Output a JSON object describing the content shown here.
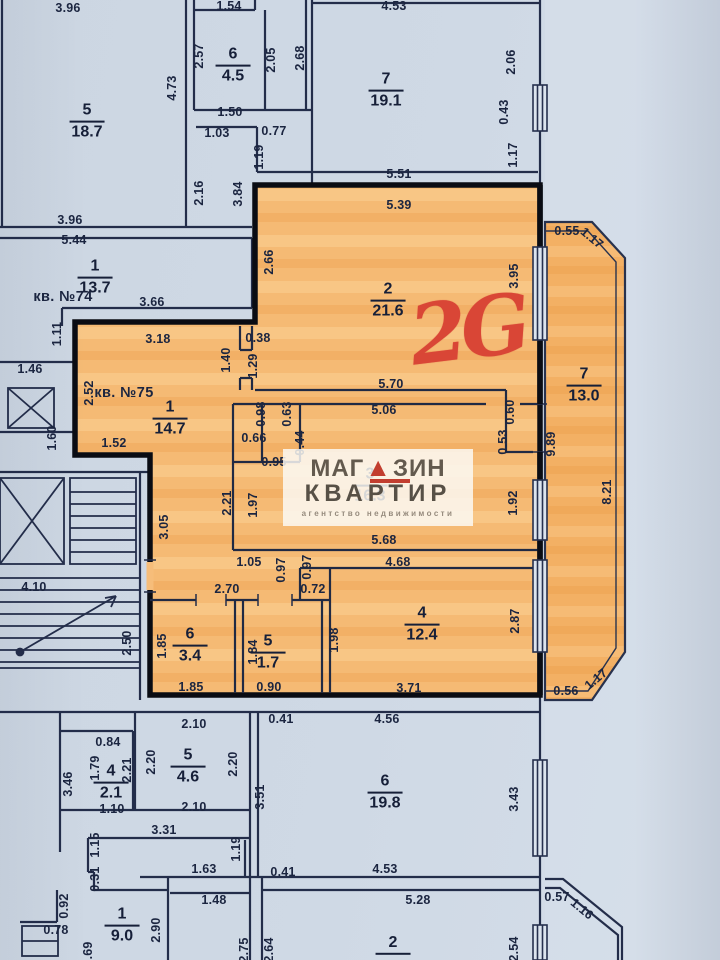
{
  "colors": {
    "background": "#cfd9e5",
    "outside": "#d6dfea",
    "wall_thin": "#232d4a",
    "wall_thick": "#0a0c13",
    "apartment_fill": "#f6bd7a",
    "balcony_fill": "#f3b268",
    "red_mark": "#d94636",
    "watermark_text": "#575046",
    "watermark_red": "#c23e2f",
    "label_text": "#1b2540"
  },
  "apartment_mark": "2G",
  "watermark": {
    "line1_left": "МАГ",
    "triangle_icon": "▲",
    "line1_right": "ЗИН",
    "line2": "КВАРТИР",
    "subtitle": "агентство недвижимости"
  },
  "unit_labels": [
    {
      "t": "кв. №74",
      "x": 63,
      "y": 297
    },
    {
      "t": "кв. №75",
      "x": 124,
      "y": 393
    }
  ],
  "rooms": [
    {
      "num": "5",
      "area": "18.7",
      "x": 87,
      "y": 122
    },
    {
      "num": "6",
      "area": "4.5",
      "x": 233,
      "y": 66
    },
    {
      "num": "7",
      "area": "19.1",
      "x": 386,
      "y": 91
    },
    {
      "num": "1",
      "area": "13.7",
      "x": 95,
      "y": 278
    },
    {
      "num": "1",
      "area": "14.7",
      "x": 170,
      "y": 419
    },
    {
      "num": "2",
      "area": "21.6",
      "x": 388,
      "y": 301
    },
    {
      "num": "3",
      "area": "16.3",
      "x": 370,
      "y": 486
    },
    {
      "num": "7",
      "area": "13.0",
      "x": 584,
      "y": 386
    },
    {
      "num": "4",
      "area": "12.4",
      "x": 422,
      "y": 625
    },
    {
      "num": "6",
      "area": "3.4",
      "x": 190,
      "y": 646
    },
    {
      "num": "5",
      "area": "1.7",
      "x": 268,
      "y": 653
    },
    {
      "num": "4",
      "area": "2.1",
      "x": 111,
      "y": 783
    },
    {
      "num": "5",
      "area": "4.6",
      "x": 188,
      "y": 767
    },
    {
      "num": "6",
      "area": "19.8",
      "x": 385,
      "y": 793
    },
    {
      "num": "1",
      "area": "9.0",
      "x": 122,
      "y": 926
    },
    {
      "num": "2",
      "area": "",
      "x": 393,
      "y": 952
    }
  ],
  "dims": [
    {
      "t": "3.96",
      "x": 68,
      "y": 8
    },
    {
      "t": "1.54",
      "x": 229,
      "y": 6
    },
    {
      "t": "4.53",
      "x": 394,
      "y": 6
    },
    {
      "t": "2.57",
      "x": 199,
      "y": 56,
      "r": -90
    },
    {
      "t": "2.05",
      "x": 271,
      "y": 60,
      "r": -90
    },
    {
      "t": "2.68",
      "x": 300,
      "y": 58,
      "r": -90
    },
    {
      "t": "4.73",
      "x": 172,
      "y": 88,
      "r": -90
    },
    {
      "t": "2.06",
      "x": 511,
      "y": 62,
      "r": -90
    },
    {
      "t": "1.50",
      "x": 230,
      "y": 112
    },
    {
      "t": "0.43",
      "x": 504,
      "y": 112,
      "r": -90
    },
    {
      "t": "1.03",
      "x": 217,
      "y": 133
    },
    {
      "t": "0.77",
      "x": 274,
      "y": 131
    },
    {
      "t": "1.19",
      "x": 259,
      "y": 157,
      "r": -90
    },
    {
      "t": "1.17",
      "x": 513,
      "y": 155,
      "r": -90
    },
    {
      "t": "5.51",
      "x": 399,
      "y": 174
    },
    {
      "t": "2.16",
      "x": 199,
      "y": 193,
      "r": -90
    },
    {
      "t": "3.84",
      "x": 238,
      "y": 194,
      "r": -90
    },
    {
      "t": "3.96",
      "x": 70,
      "y": 220
    },
    {
      "t": "5.44",
      "x": 74,
      "y": 240
    },
    {
      "t": "5.39",
      "x": 399,
      "y": 205
    },
    {
      "t": "0.55",
      "x": 567,
      "y": 231
    },
    {
      "t": "1.17",
      "x": 592,
      "y": 238,
      "r": 40
    },
    {
      "t": "2.66",
      "x": 269,
      "y": 262,
      "r": -90
    },
    {
      "t": "3.95",
      "x": 514,
      "y": 276,
      "r": -90
    },
    {
      "t": "3.66",
      "x": 152,
      "y": 302
    },
    {
      "t": "1.11",
      "x": 57,
      "y": 334,
      "r": -90
    },
    {
      "t": "3.18",
      "x": 158,
      "y": 339
    },
    {
      "t": "0.38",
      "x": 258,
      "y": 338
    },
    {
      "t": "1.40",
      "x": 226,
      "y": 360,
      "r": -90
    },
    {
      "t": "1.29",
      "x": 253,
      "y": 366,
      "r": -90
    },
    {
      "t": "1.46",
      "x": 30,
      "y": 369
    },
    {
      "t": "2.52",
      "x": 89,
      "y": 393,
      "r": -90
    },
    {
      "t": "5.70",
      "x": 391,
      "y": 384
    },
    {
      "t": "5.06",
      "x": 384,
      "y": 410
    },
    {
      "t": "0.98",
      "x": 261,
      "y": 414,
      "r": -90
    },
    {
      "t": "0.63",
      "x": 287,
      "y": 414,
      "r": -90
    },
    {
      "t": "0.60",
      "x": 510,
      "y": 412,
      "r": -90
    },
    {
      "t": "1.60",
      "x": 52,
      "y": 438,
      "r": -90
    },
    {
      "t": "0.66",
      "x": 254,
      "y": 438
    },
    {
      "t": "0.44",
      "x": 300,
      "y": 443,
      "r": -90
    },
    {
      "t": "0.53",
      "x": 503,
      "y": 442,
      "r": -90
    },
    {
      "t": "9.89",
      "x": 551,
      "y": 444,
      "r": -90
    },
    {
      "t": "1.52",
      "x": 114,
      "y": 443
    },
    {
      "t": "0.95",
      "x": 274,
      "y": 462
    },
    {
      "t": "8.21",
      "x": 607,
      "y": 492,
      "r": -90
    },
    {
      "t": "2.21",
      "x": 227,
      "y": 503,
      "r": -90
    },
    {
      "t": "1.97",
      "x": 253,
      "y": 505,
      "r": -90
    },
    {
      "t": "1.92",
      "x": 513,
      "y": 503,
      "r": -90
    },
    {
      "t": "3.05",
      "x": 164,
      "y": 527,
      "r": -90
    },
    {
      "t": "5.68",
      "x": 384,
      "y": 540
    },
    {
      "t": "4.68",
      "x": 398,
      "y": 562
    },
    {
      "t": "1.05",
      "x": 249,
      "y": 562
    },
    {
      "t": "0.97",
      "x": 281,
      "y": 570,
      "r": -90
    },
    {
      "t": "0.97",
      "x": 307,
      "y": 567,
      "r": -90
    },
    {
      "t": "4.10",
      "x": 34,
      "y": 587
    },
    {
      "t": "2.70",
      "x": 227,
      "y": 589
    },
    {
      "t": "0.72",
      "x": 313,
      "y": 589
    },
    {
      "t": "2.87",
      "x": 515,
      "y": 621,
      "r": -90
    },
    {
      "t": "1.98",
      "x": 334,
      "y": 640,
      "r": -90
    },
    {
      "t": "2.50",
      "x": 127,
      "y": 643,
      "r": -90
    },
    {
      "t": "1.85",
      "x": 162,
      "y": 646,
      "r": -90
    },
    {
      "t": "1.84",
      "x": 253,
      "y": 652,
      "r": -90
    },
    {
      "t": "1.17",
      "x": 596,
      "y": 679,
      "r": -40
    },
    {
      "t": "1.85",
      "x": 191,
      "y": 687
    },
    {
      "t": "0.90",
      "x": 269,
      "y": 687
    },
    {
      "t": "3.71",
      "x": 409,
      "y": 688
    },
    {
      "t": "0.56",
      "x": 566,
      "y": 691
    },
    {
      "t": "2.10",
      "x": 194,
      "y": 724
    },
    {
      "t": "0.41",
      "x": 281,
      "y": 719
    },
    {
      "t": "4.56",
      "x": 387,
      "y": 719
    },
    {
      "t": "0.84",
      "x": 108,
      "y": 742
    },
    {
      "t": "2.20",
      "x": 151,
      "y": 762,
      "r": -90
    },
    {
      "t": "2.20",
      "x": 233,
      "y": 764,
      "r": -90
    },
    {
      "t": "1.79",
      "x": 95,
      "y": 768,
      "r": -90
    },
    {
      "t": "2.21",
      "x": 127,
      "y": 770,
      "r": -90
    },
    {
      "t": "3.46",
      "x": 68,
      "y": 784,
      "r": -90
    },
    {
      "t": "3.51",
      "x": 260,
      "y": 797,
      "r": -90
    },
    {
      "t": "3.43",
      "x": 514,
      "y": 799,
      "r": -90
    },
    {
      "t": "2.10",
      "x": 194,
      "y": 807
    },
    {
      "t": "1.10",
      "x": 112,
      "y": 809
    },
    {
      "t": "3.31",
      "x": 164,
      "y": 830
    },
    {
      "t": "1.15",
      "x": 95,
      "y": 845,
      "r": -90
    },
    {
      "t": "1.19",
      "x": 236,
      "y": 849,
      "r": -90
    },
    {
      "t": "1.63",
      "x": 204,
      "y": 869
    },
    {
      "t": "0.41",
      "x": 283,
      "y": 872
    },
    {
      "t": "4.53",
      "x": 385,
      "y": 869
    },
    {
      "t": "0.31",
      "x": 95,
      "y": 879,
      "r": -90
    },
    {
      "t": "0.57",
      "x": 557,
      "y": 897
    },
    {
      "t": "1.48",
      "x": 214,
      "y": 900
    },
    {
      "t": "5.28",
      "x": 418,
      "y": 900
    },
    {
      "t": "1.16",
      "x": 582,
      "y": 909,
      "r": 40
    },
    {
      "t": "0.92",
      "x": 64,
      "y": 906,
      "r": -90
    },
    {
      "t": "0.78",
      "x": 56,
      "y": 930
    },
    {
      "t": "2.90",
      "x": 156,
      "y": 930,
      "r": -90
    },
    {
      "t": "2.75",
      "x": 244,
      "y": 950,
      "r": -90
    },
    {
      "t": "2.64",
      "x": 269,
      "y": 950,
      "r": -90
    },
    {
      "t": "2.54",
      "x": 514,
      "y": 949,
      "r": -90
    },
    {
      "t": "0.69",
      "x": 88,
      "y": 954,
      "r": -90
    }
  ]
}
